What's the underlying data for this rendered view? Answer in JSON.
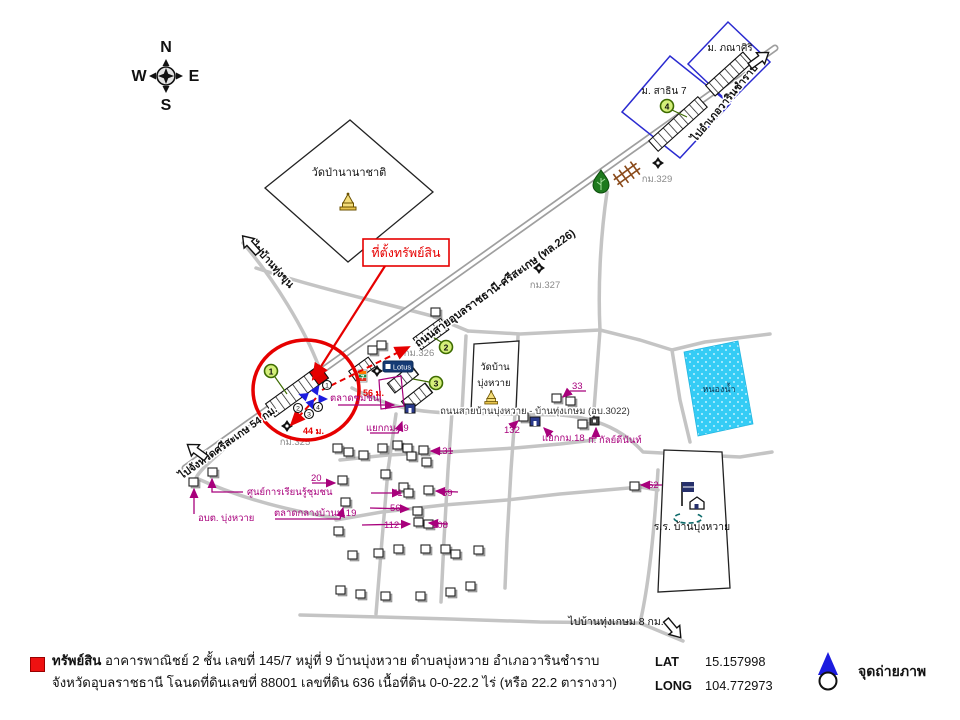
{
  "compass": {
    "n": "N",
    "e": "E",
    "w": "W",
    "s": "S"
  },
  "colors": {
    "red": "#e60000",
    "magenta": "#a8007c",
    "pond_blue": "#35ccf5",
    "marker_green": "#d4ef7a",
    "photo_blue": "#1c1cdf",
    "parcel_blue": "#2a2ad0",
    "road_gray": "#c4c4c4"
  },
  "map": {
    "callout_label": "ที่ตั้งทรัพย์สิน",
    "roads": {
      "highway_label": "ถนนสายอุบลราชธานี-ศรีสะเกษ (ทล.226)",
      "to_warin": "ไปอำเภอวารินชำราบ",
      "to_sisaket": "ไปจังหวัดศรีสะเกษ 54 กม.",
      "to_thungkhun": "ไปบ้านทุ่งขุน",
      "local_road_label": "ถนนสายบ้านบุ่งหวาย - บ้านทุ่งเกษม (อบ.3022)",
      "to_thungkasem": "ไปบ้านทุ่งเกษม 8 กม."
    },
    "places": {
      "wat_pa_nanachat": "วัดป่านานาชาติ",
      "wat_ban_1": "วัดบ้าน",
      "wat_ban_2": "บุ่งหวาย",
      "school": "ร.ร. บ้านบุ่งหวาย",
      "pond": "หนองน้ำ",
      "moo_sathin": "ม. สาธิน 7",
      "moo_phanasiri": "ม. ภณาศิริ",
      "market": "ตลาดชุมชน",
      "learning_center": "ศูนย์การเรียนรู้ชุมชน",
      "obt_bungwai": "อบต. บุ่งหวาย",
      "central_market": "ตลาดกลางบ้านม.19",
      "junction18": "แยกกม.18",
      "junction19": "แยกกม.19",
      "kanladinan": "ก. กัลย์ดีนันท์",
      "lotus": "Lotus",
      "seven": "7"
    },
    "km_markers": [
      "กม.325",
      "กม.326",
      "กม.327",
      "กม.329"
    ],
    "distances": [
      "44 ม.",
      "56 ม."
    ],
    "house_numbers": [
      "20",
      "33",
      "131",
      "71",
      "59",
      "56",
      "112",
      "108",
      "132",
      "62"
    ],
    "green_points": [
      "1",
      "2",
      "3",
      "4"
    ],
    "photo_points": [
      "1",
      "2",
      "3",
      "4"
    ]
  },
  "legend": {
    "property_term": "ทรัพย์สิน",
    "line1": "อาคารพาณิชย์ 2 ชั้น เลขที่ 145/7 หมู่ที่ 9 บ้านบุ่งหวาย ตำบลบุ่งหวาย อำเภอวารินชำราบ",
    "line2": "จังหวัดอุบลราชธานี โฉนดที่ดินเลขที่ 88001 เลขที่ดิน 636 เนื้อที่ดิน 0-0-22.2 ไร่ (หรือ 22.2 ตารางวา)",
    "lat_label": "LAT",
    "lat_value": "15.157998",
    "long_label": "LONG",
    "long_value": "104.772973",
    "photo_label": "จุดถ่ายภาพ"
  }
}
